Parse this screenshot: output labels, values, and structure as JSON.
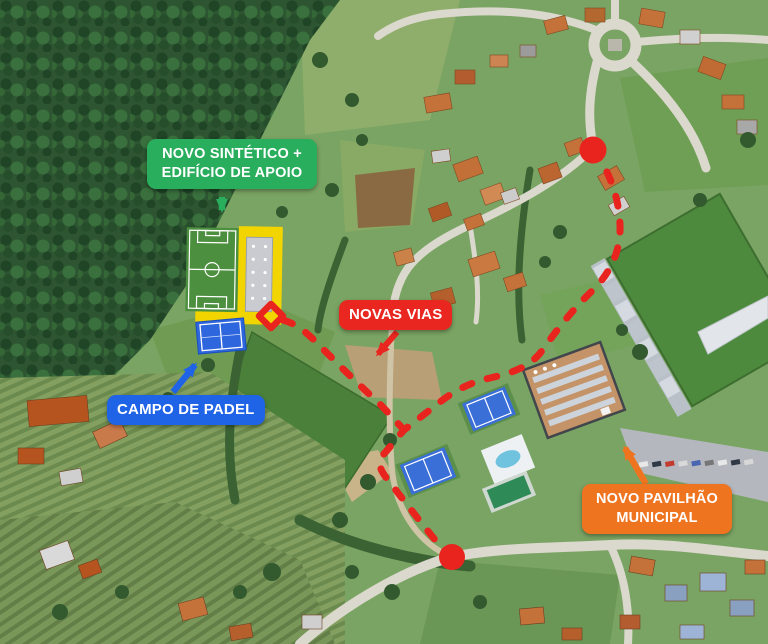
{
  "annotations": {
    "novo_sintetico": {
      "line1": "NOVO SINTÉTICO +",
      "line2": "EDIFÍCIO DE APOIO",
      "color": "#29ae5d"
    },
    "novas_vias": {
      "label": "NOVAS VIAS",
      "color": "#e9261f"
    },
    "campo_padel": {
      "label": "CAMPO DE PADEL",
      "color": "#1f63e6"
    },
    "novo_pavilhao": {
      "line1": "NOVO PAVILHÃO",
      "line2": "MUNICIPAL",
      "color": "#ef7420"
    },
    "route": {
      "color": "#e9241f",
      "style": "dashed",
      "endpoints": 2,
      "junction": "diamond"
    }
  }
}
